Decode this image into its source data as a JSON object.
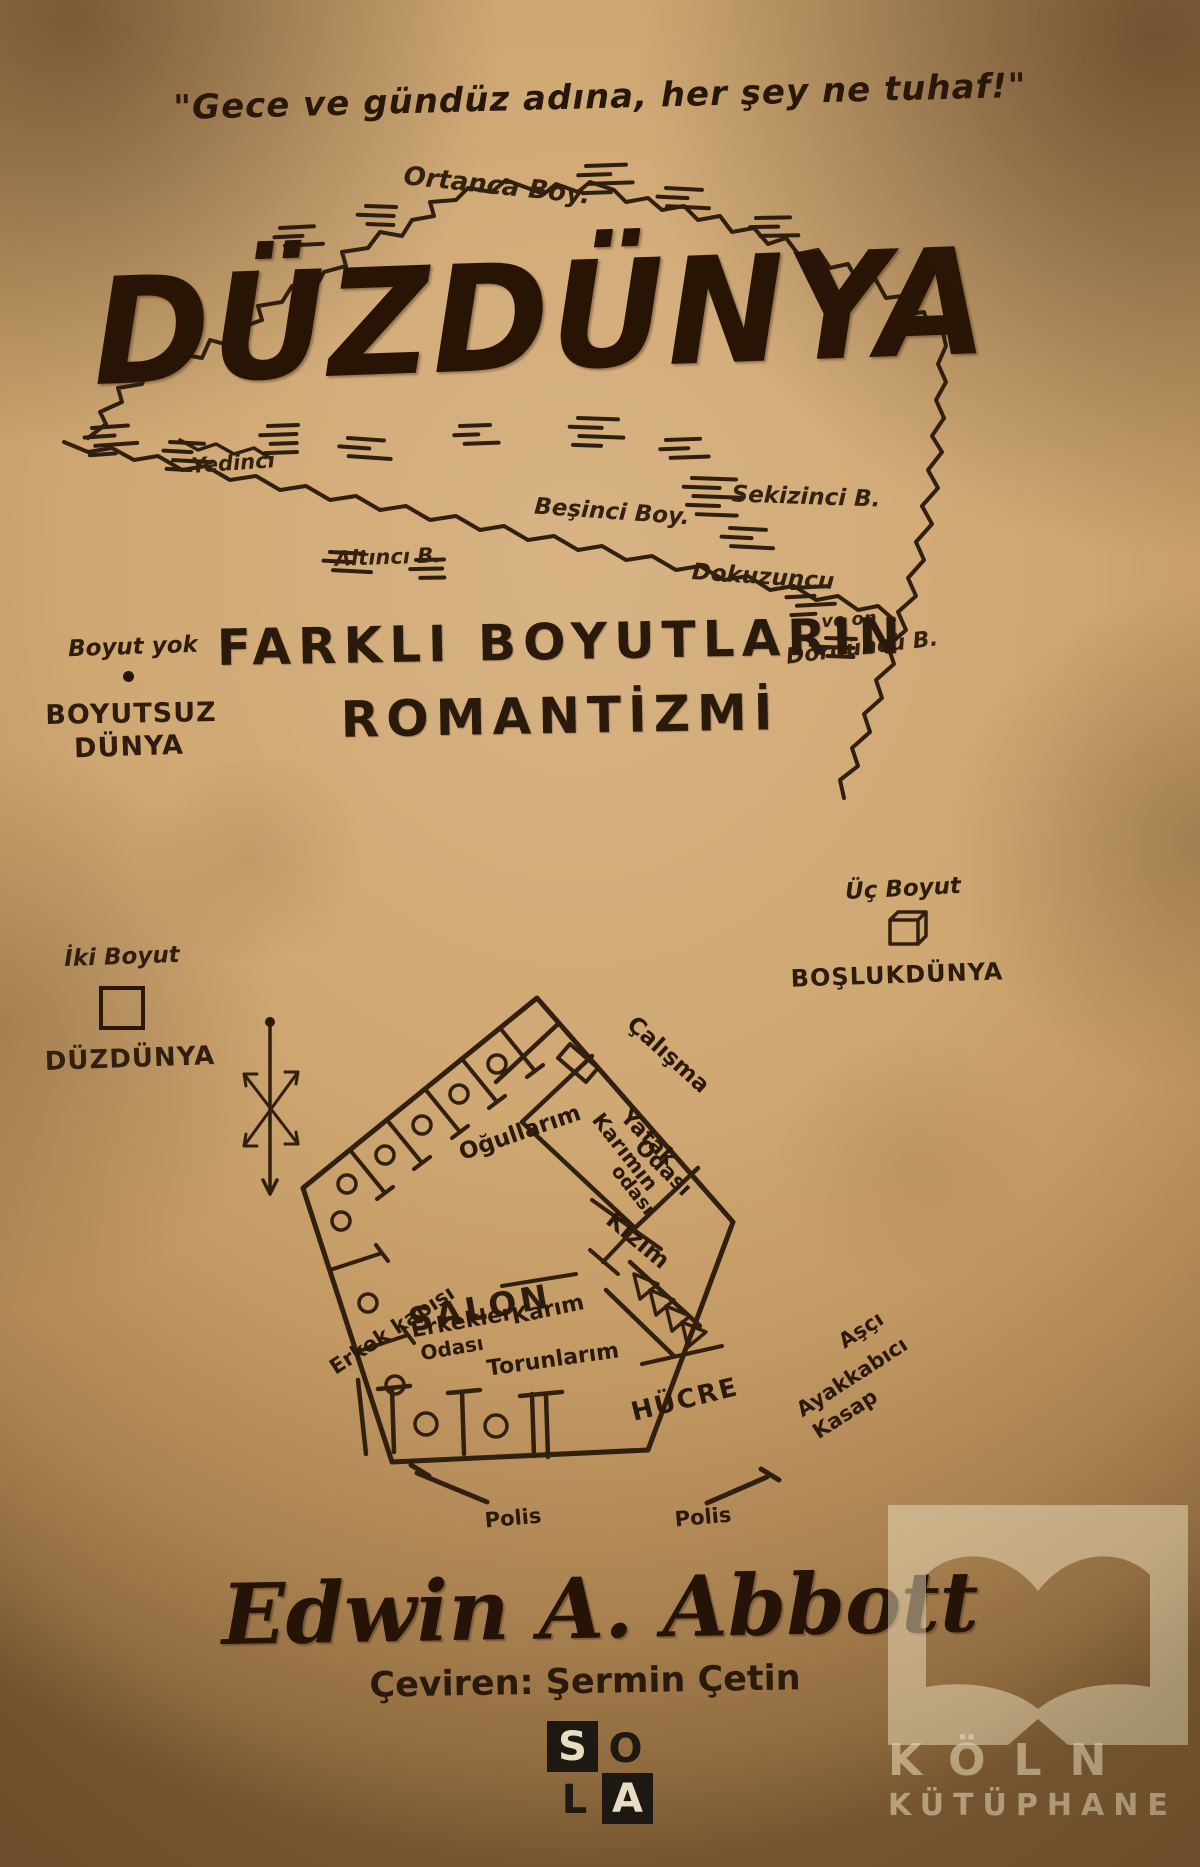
{
  "quote": {
    "text": "\"Gece ve gündüz adına, her şey ne tuhaf!\""
  },
  "title": {
    "text": "DÜZDÜNYA"
  },
  "subtitle": {
    "line1": "FARKLI BOYUTLARIN",
    "line2": "ROMANTİZMİ"
  },
  "map": {
    "ortanca": "Ortanca Boy.",
    "yedinci": "Yedinci",
    "besinci": "Beşinci Boy.",
    "sekizinci": "Sekizinci B.",
    "altinci": "Altıncı B.",
    "dokuzuncu": "Dokuzuncu",
    "on": "ve on",
    "dorduncu": "Dördüncü B."
  },
  "dims": {
    "zero": {
      "caption": "Boyut yok",
      "name1": "BOYUTSUZ",
      "name2": "DÜNYA",
      "symbol": "point-icon"
    },
    "two": {
      "caption": "İki Boyut",
      "name": "DÜZDÜNYA",
      "symbol": "square-icon"
    },
    "three": {
      "caption": "Üç Boyut",
      "name": "BOŞLUKDÜNYA",
      "symbol": "cube-icon"
    }
  },
  "house": {
    "ogullarim": "Oğullarım",
    "calisma": "Çalışma",
    "yatak1": "Yatak",
    "yatak2": "Odası",
    "karimin1": "Karımın",
    "karimin2": "odası",
    "kizim": "Kızım",
    "salon": "SALON",
    "erkek_kapisi": "Erkek kapısı",
    "erkekler1": "Erkekler",
    "erkekler2": "Odası",
    "karim": "Karım",
    "torunlarim": "Torunlarım",
    "hucre": "HÜCRE",
    "asci": "Aşçı",
    "ayakkabici": "Ayakkabıcı",
    "kasap": "Kasap",
    "polis_left": "Polis",
    "polis_right": "Polis"
  },
  "author": {
    "name": "Edwin A. Abbott",
    "translator": "Çeviren: Şermin Çetin"
  },
  "publisher": {
    "s": "S",
    "o": "O",
    "l": "L",
    "a": "A"
  },
  "watermark": {
    "line1": "KÖLN",
    "line2": "KÜTÜPHANE",
    "icon": "open-book-icon"
  },
  "colors": {
    "paper": "#cfa873",
    "ink": "#2e1d0e",
    "title_ink": "#281405",
    "block": "#1d1812",
    "watermark": "#eee1c1"
  }
}
